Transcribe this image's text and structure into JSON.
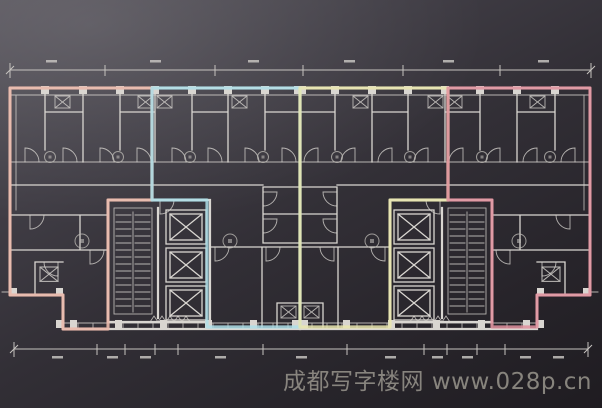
{
  "watermark": {
    "text": "成都写字楼网 www.028p.cn"
  },
  "colors": {
    "line": "#d9d6d1",
    "line_dim": "#c6c3bf",
    "unit_salmon": "#eab7a9",
    "unit_cyan": "#aedfe9",
    "unit_yellow": "#e9e6ae",
    "unit_pink": "#e0919d",
    "watermark": "#938f88",
    "bg_light": "#55525a",
    "bg_dark": "#1f1c21"
  },
  "plan": {
    "type": "office-tower typical floor plan, dark blueprint photo",
    "units": [
      {
        "id": "unit-left-end",
        "overlay_color": "unit_salmon"
      },
      {
        "id": "unit-left-center",
        "overlay_color": "unit_cyan"
      },
      {
        "id": "unit-right-center",
        "overlay_color": "unit_yellow"
      },
      {
        "id": "unit-right-end",
        "overlay_color": "unit_pink"
      }
    ],
    "cores": 2,
    "elevators_per_core": 3,
    "stairs_per_core": 1,
    "room_label_circles": {
      "top_row": 8,
      "lower_row": 4
    },
    "dimension_lines": {
      "top": true,
      "bottom": true,
      "labels_legible": false
    }
  }
}
